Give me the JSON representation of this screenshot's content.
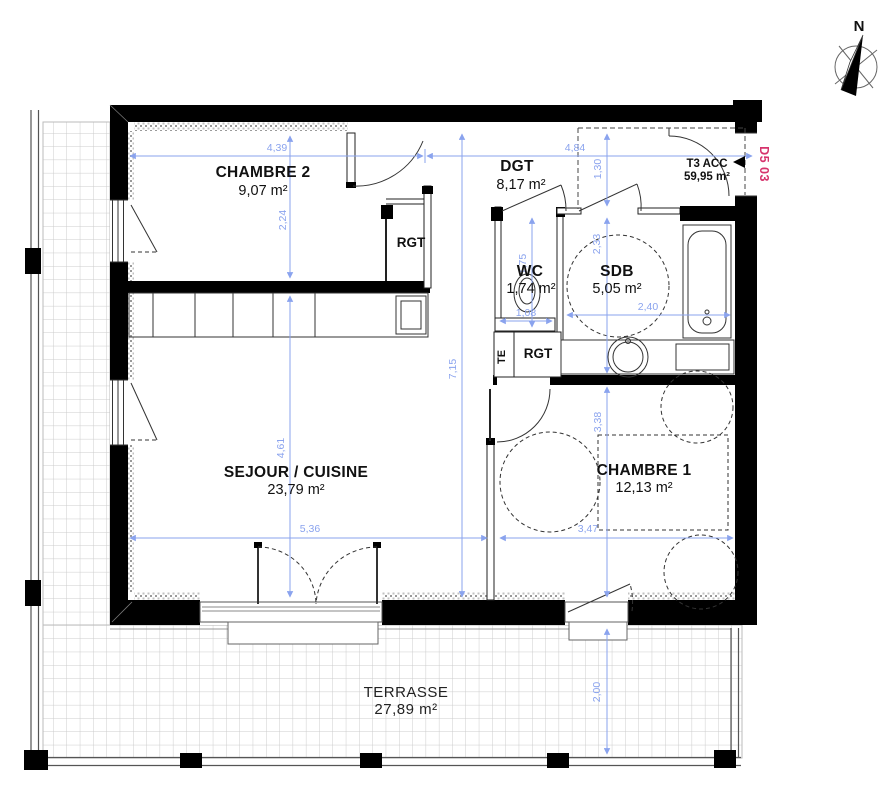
{
  "unit": {
    "type_label": "T3 ACC",
    "total_area": "59,95 m²",
    "plan_ref": "D5 03",
    "north_label": "N"
  },
  "rooms": {
    "chambre2": {
      "name": "CHAMBRE 2",
      "area": "9,07 m²"
    },
    "dgt": {
      "name": "DGT",
      "area": "8,17 m²"
    },
    "wc": {
      "name": "WC",
      "area": "1,74 m²"
    },
    "sdb": {
      "name": "SDB",
      "area": "5,05 m²"
    },
    "sejour": {
      "name": "SEJOUR / CUISINE",
      "area": "23,79 m²"
    },
    "chambre1": {
      "name": "CHAMBRE 1",
      "area": "12,13 m²"
    },
    "terrasse": {
      "name": "TERRASSE",
      "area": "27,89 m²"
    }
  },
  "storage": {
    "rgt_bedroom": "RGT",
    "rgt_hall": "RGT",
    "te": "TE"
  },
  "dimensions": {
    "chambre2_width": "4,39",
    "hall_width": "4,84",
    "chambre2_height": "2,24",
    "sejour_height": "4,61",
    "interior_height_total": "7,15",
    "entry_depth": "1,30",
    "sdb_height": "2,33",
    "chambre1_height": "3,38",
    "wc_height": "1,75",
    "wc_width": "1,08",
    "sdb_width": "2,40",
    "sejour_width": "5,36",
    "chambre1_width": "3,47",
    "terrasse_depth": "2,00"
  },
  "colors": {
    "dimension_blue": "#8aa3ee",
    "plan_ref_pink": "#d6336c",
    "wall_black": "#000000"
  }
}
